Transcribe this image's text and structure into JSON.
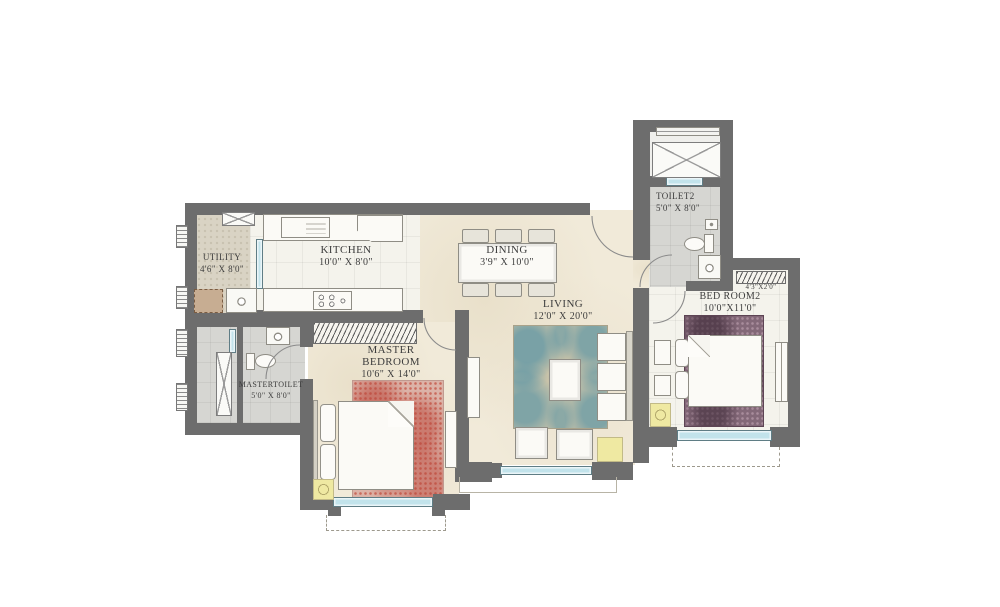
{
  "plan": {
    "rooms": {
      "utility": {
        "label": "UTILITY",
        "dim": "4'6\" X 8'0\""
      },
      "kitchen": {
        "label": "KITCHEN",
        "dim": "10'0\" X 8'0\""
      },
      "dining": {
        "label": "DINING",
        "dim": "3'9\" X 10'0\""
      },
      "living": {
        "label": "LIVING",
        "dim": "12'0\" X 20'0\""
      },
      "master_bedroom": {
        "label_line1": "MASTER",
        "label_line2": "BEDROOM",
        "dim": "10'6\" X 14'0\""
      },
      "master_toilet": {
        "label": "MASTERTOILET",
        "dim": "5'0\" X 8'0\""
      },
      "toilet2": {
        "label": "TOILET2",
        "dim": "5'0\" X 8'0\""
      },
      "bedroom2": {
        "label": "BED ROOM2",
        "dim": "10'0\"X11'0\""
      },
      "ledge": {
        "dim": "4'3\"X2'0\""
      }
    },
    "colors": {
      "wall": "#6d6d6d",
      "floor_cream": "#f1ead9",
      "floor_tile_light": "#f4f3ec",
      "floor_tile_gray": "#d6d6d2",
      "floor_utility": "#d9d3c4",
      "window_blue": "#c2e3eb",
      "accent_yellow": "#efe9a2",
      "rug_master": "#dcb3a8",
      "rug_bedroom2": "#836878",
      "rug_living_base": "#c9c3a9",
      "rug_living_accent": "#4e8fa4"
    }
  }
}
